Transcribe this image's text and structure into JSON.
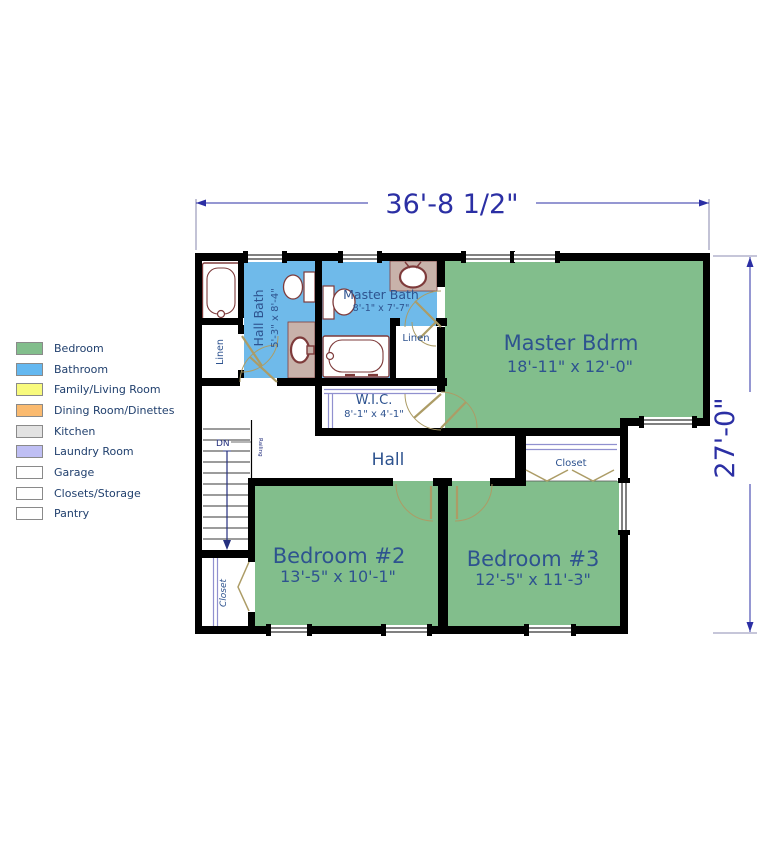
{
  "legend": {
    "items": [
      {
        "label": "Bedroom",
        "color": "#82BE8C"
      },
      {
        "label": "Bathroom",
        "color": "#64B8F0"
      },
      {
        "label": "Family/Living Room",
        "color": "#F8FA7D"
      },
      {
        "label": "Dining Room/Dinettes",
        "color": "#FABA6F"
      },
      {
        "label": "Kitchen",
        "color": "#E2E2E2"
      },
      {
        "label": "Laundry Room",
        "color": "#BFBFF4"
      },
      {
        "label": "Garage",
        "color": "#FFFFFF"
      },
      {
        "label": "Closets/Storage",
        "color": "#FFFFFF"
      },
      {
        "label": "Pantry",
        "color": "#FFFFFF"
      }
    ]
  },
  "dimensions": {
    "width": "36'-8 1/2\"",
    "height": "27'-0\""
  },
  "rooms": {
    "hall_bath": {
      "name": "Hall Bath",
      "dims": "5'-3\" x 8'-4\""
    },
    "master_bath": {
      "name": "Master Bath",
      "dims": "8'-1\" x 7'-7\""
    },
    "wic": {
      "name": "W.I.C.",
      "dims": "8'-1\" x 4'-1\""
    },
    "master_bdrm": {
      "name": "Master Bdrm",
      "dims": "18'-11\" x 12'-0\""
    },
    "hall": {
      "name": "Hall"
    },
    "bedroom2": {
      "name": "Bedroom #2",
      "dims": "13'-5\" x 10'-1\""
    },
    "bedroom3": {
      "name": "Bedroom #3",
      "dims": "12'-5\" x 11'-3\""
    },
    "linen_hall": {
      "name": "Linen"
    },
    "linen_master": {
      "name": "Linen"
    },
    "closet_bd2": {
      "name": "Closet"
    },
    "closet_bd3": {
      "name": "Closet"
    },
    "stairs": {
      "down_label": "DN",
      "railing_label": "Railing"
    }
  },
  "colors": {
    "bedroom_fill": "#82BE8C",
    "bathroom_fill": "#6FBAEA",
    "wall": "#000000",
    "fixture_outline": "#7E3B3B",
    "vanity_fill": "#C8B2AA",
    "door_swing": "#AC9C66",
    "shelf_line": "#9090CF",
    "room_label": "#2E538F",
    "dimension_text": "#2B2FA4"
  }
}
